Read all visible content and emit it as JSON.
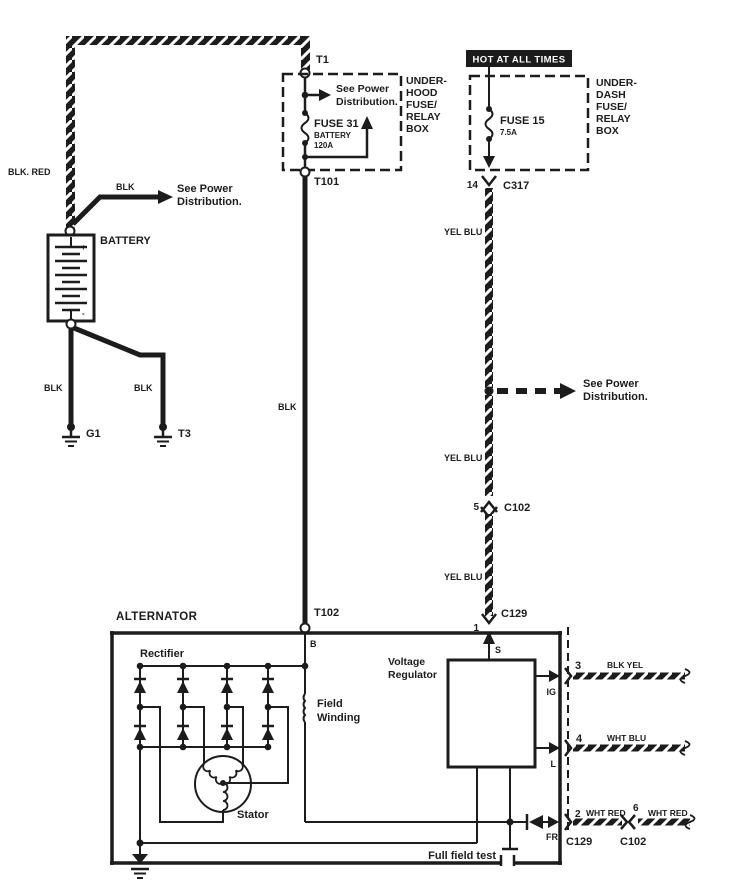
{
  "colors": {
    "ink": "#1c1c1c",
    "paper": "#ffffff"
  },
  "battery_section": {
    "wire_blk_red": "BLK. RED",
    "branch_wire_color": "BLK",
    "see_power_1": "See Power",
    "see_power_2": "Distribution.",
    "battery_label": "BATTERY",
    "plus": "+",
    "minus": "-",
    "ground_left_wire": "BLK",
    "ground_right_wire": "BLK",
    "ground_left_id": "G1",
    "ground_right_id": "T3"
  },
  "underhood_box": {
    "terminal_top": "T1",
    "terminal_bottom": "T101",
    "name": [
      "UNDER-",
      "HOOD",
      "FUSE/",
      "RELAY",
      "BOX"
    ],
    "see_power_1": "See Power",
    "see_power_2": "Distribution.",
    "fuse": "FUSE 31",
    "fuse_circuit": "BATTERY",
    "fuse_rating": "120A"
  },
  "underdash_box": {
    "banner": "HOT AT ALL TIMES",
    "name": [
      "UNDER-",
      "DASH",
      "FUSE/",
      "RELAY",
      "BOX"
    ],
    "fuse": "FUSE 15",
    "fuse_rating": "7.5A",
    "pin": "14",
    "connector": "C317"
  },
  "center_harness": {
    "wire_color": "BLK",
    "terminal": "T102"
  },
  "right_harness": {
    "wire_color_1": "YEL BLU",
    "see_power_1": "See Power",
    "see_power_2": "Distribution.",
    "pin_5": "5",
    "connector_c102": "C102",
    "wire_color_2": "YEL BLU",
    "wire_color_3": "YEL BLU",
    "connector_c129": "C129",
    "pin_1": "1"
  },
  "alternator": {
    "name": "ALTERNATOR",
    "terminal_b": "B",
    "rectifier_label": "Rectifier",
    "field_winding_label": [
      "Field",
      "Winding"
    ],
    "voltage_regulator_label": [
      "Voltage",
      "Regulator"
    ],
    "stator_label": "Stator",
    "terminal_s": "S",
    "terminal_ig": "IG",
    "terminal_l": "L",
    "terminal_fr": "FR",
    "full_field_test_label": "Full field test"
  },
  "outputs": {
    "pin_3": "3",
    "wire_3_color": "BLK YEL",
    "pin_4": "4",
    "wire_4_color": "WHT BLU",
    "pin_2": "2",
    "wire_2_color": "WHT RED",
    "connector_c129": "C129",
    "pin_6": "6",
    "wire_6_color": "WHT RED",
    "connector_c102": "C102"
  }
}
